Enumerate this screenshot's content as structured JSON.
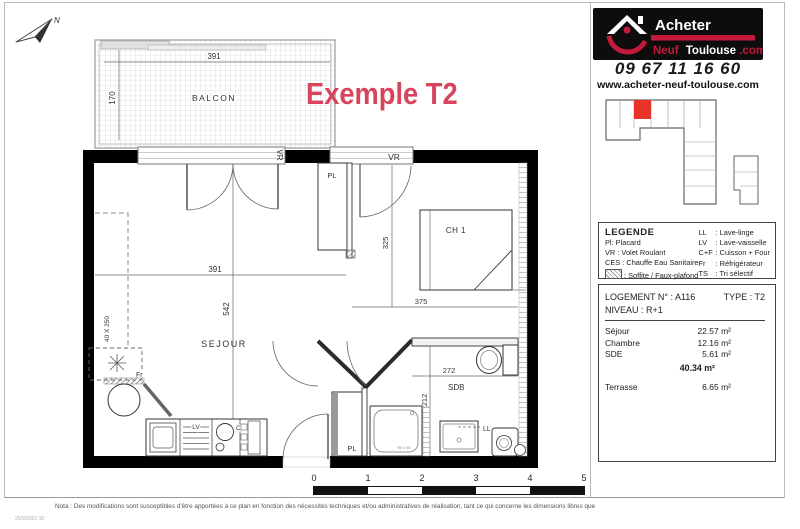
{
  "sheet": {
    "title": "Exemple T2",
    "nota": "Nota : Des modifications sont susceptibles d'être apportées à ce plan en fonction des nécessités techniques et/ou administratives de réalisation, tant ce qui concerne les dimensions libres que",
    "stamp": "25/9/2021 10"
  },
  "brand": {
    "name_top": "Acheter",
    "name_neuf": "Neuf",
    "name_toulouse": "Toulouse",
    "name_dot": ".com",
    "phone": "09 67 11 16 60",
    "website": "www.acheter-neuf-toulouse.com",
    "accent_red": "#c4183c",
    "highlight_red": "#e8332a"
  },
  "legend": {
    "heading": "LEGENDE",
    "left": [
      {
        "text": "Pl: Placard"
      },
      {
        "text": "VR : Volet Roulant"
      },
      {
        "text": "CES : Chauffe Eau Sanitaire"
      },
      {
        "text": ": Soffite / Faux-plafond"
      }
    ],
    "right": [
      {
        "abbr": "LL",
        "label": ": Lave-linge"
      },
      {
        "abbr": "LV",
        "label": ": Lave-vaisselle"
      },
      {
        "abbr": "C+F",
        "label": ": Cuisson + Four"
      },
      {
        "abbr": "Fr",
        "label": ": Réfrigérateur"
      },
      {
        "abbr": "TS",
        "label": ": Tri sélectif"
      }
    ]
  },
  "unit": {
    "logement": "LOGEMENT N° : A116",
    "type": "TYPE : T2",
    "niveau": "NIVEAU : R+1",
    "areas": [
      {
        "name": "Séjour",
        "value": "22.57 m²"
      },
      {
        "name": "Chambre",
        "value": "12.16 m²"
      },
      {
        "name": "SDE",
        "value": "5.61 m²"
      }
    ],
    "total": "40.34 m²",
    "terrasse_name": "Terrasse",
    "terrasse_value": "6.65 m²"
  },
  "plan": {
    "labels": {
      "balcon": "BALCON",
      "sejour": "SEJOUR",
      "ch1": "CH 1",
      "sdb": "SDB",
      "pl_ch1": "PL",
      "pl_hall": "PL",
      "vr_sejour": "VR",
      "vr_ch1": "VR",
      "fr": "Fr",
      "lv": "LV",
      "c": "C",
      "ll": "LL",
      "shower": "90 x 90",
      "north": "N"
    },
    "dims": {
      "balcon_w": "391",
      "balcon_h": "170",
      "sejour_w": "391",
      "sejour_h": "542",
      "ch1_h": "325",
      "ch1_w": "375",
      "sdb_w": "272",
      "sdb_h": "212",
      "soffite": "40 X 250"
    }
  },
  "scalebar": {
    "ticks": [
      "0",
      "1",
      "2",
      "3",
      "4",
      "5"
    ]
  }
}
